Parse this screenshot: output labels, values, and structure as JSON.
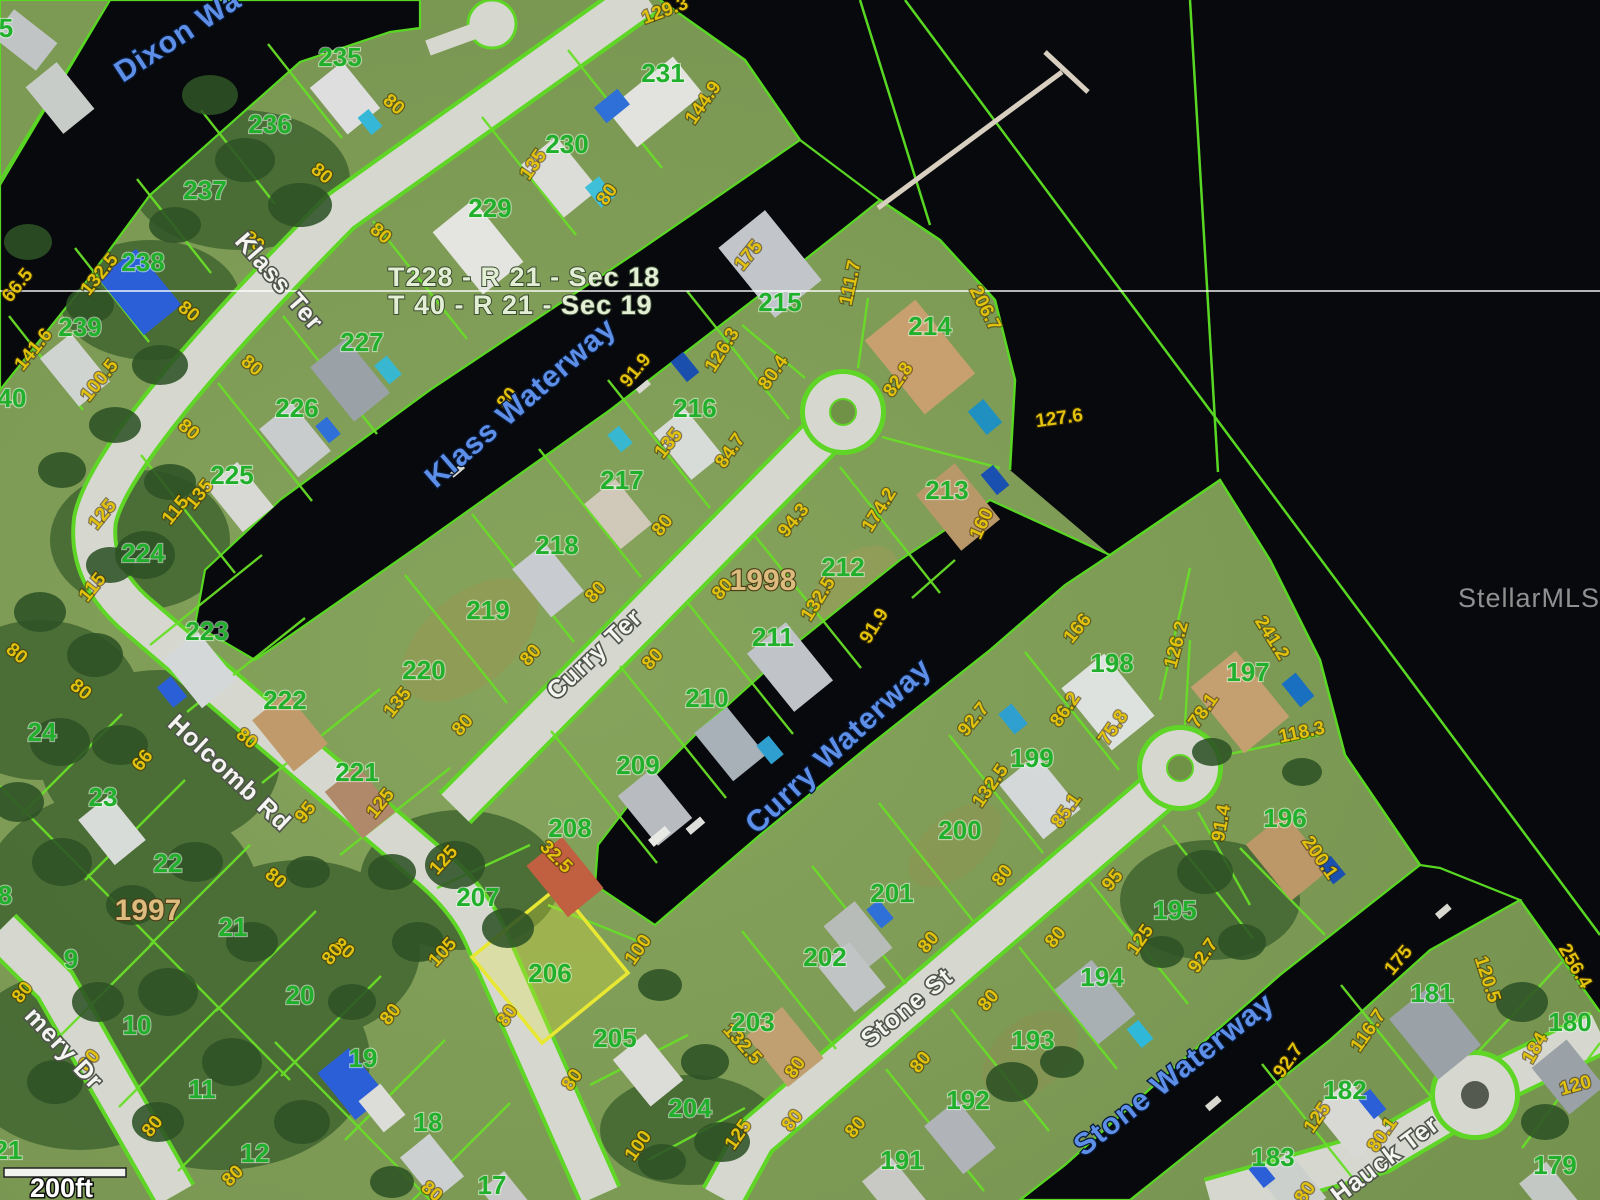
{
  "watermark": "StellarMLS",
  "scale": {
    "label": "200ft"
  },
  "section_labels": [
    "T228 - R 21 - Sec 18",
    "T 40 - R 21 - Sec 19"
  ],
  "plat_labels": [
    {
      "text": "1998",
      "x": 763,
      "y": 590
    },
    {
      "text": "1997",
      "x": 148,
      "y": 920
    }
  ],
  "highlighted_lot": "206",
  "colors": {
    "parcel_line": "#68de28",
    "highlight_parcel": "#e8e833",
    "lot_number": "#21b02c",
    "dimension_text": "#e2c20c",
    "waterway_text": "#5d8fe8",
    "street_text": "#f4f4f0",
    "water": "#07090c",
    "road": "#d6d8d0",
    "plat_text": "#dcbc7e"
  },
  "streets": [
    {
      "name": "Klass Ter",
      "x": 273,
      "y": 287,
      "rot": 49
    },
    {
      "name": "Holcomb Rd",
      "x": 224,
      "y": 779,
      "rot": 43
    },
    {
      "name": "Curry Ter",
      "x": 600,
      "y": 660,
      "rot": -43
    },
    {
      "name": "Stone St",
      "x": 912,
      "y": 1014,
      "rot": -39
    },
    {
      "name": "mery Dr",
      "x": 58,
      "y": 1054,
      "rot": 47
    },
    {
      "name": "Hauck Ter",
      "x": 1390,
      "y": 1166,
      "rot": -37
    }
  ],
  "waterways": [
    {
      "name": "Dixon Wa",
      "x": 183,
      "y": 44,
      "rot": -33
    },
    {
      "name": "Klass Waterway",
      "x": 527,
      "y": 410,
      "rot": -41
    },
    {
      "name": "Curry Waterway",
      "x": 845,
      "y": 753,
      "rot": -43
    },
    {
      "name": "Stone Waterway",
      "x": 1180,
      "y": 1082,
      "rot": -38
    }
  ],
  "lots": [
    {
      "n": "235",
      "x": 340,
      "y": 66
    },
    {
      "n": "236",
      "x": 270,
      "y": 133
    },
    {
      "n": "237",
      "x": 205,
      "y": 199
    },
    {
      "n": "238",
      "x": 143,
      "y": 271
    },
    {
      "n": "239",
      "x": 80,
      "y": 336
    },
    {
      "n": "40",
      "x": 12,
      "y": 407
    },
    {
      "n": "5",
      "x": 6,
      "y": 37
    },
    {
      "n": "231",
      "x": 663,
      "y": 82
    },
    {
      "n": "230",
      "x": 567,
      "y": 153
    },
    {
      "n": "229",
      "x": 490,
      "y": 217
    },
    {
      "n": "227",
      "x": 362,
      "y": 351
    },
    {
      "n": "226",
      "x": 297,
      "y": 417
    },
    {
      "n": "225",
      "x": 232,
      "y": 484
    },
    {
      "n": "224",
      "x": 143,
      "y": 562
    },
    {
      "n": "223",
      "x": 207,
      "y": 640
    },
    {
      "n": "222",
      "x": 285,
      "y": 709
    },
    {
      "n": "221",
      "x": 357,
      "y": 781
    },
    {
      "n": "215",
      "x": 780,
      "y": 311
    },
    {
      "n": "216",
      "x": 695,
      "y": 417
    },
    {
      "n": "217",
      "x": 622,
      "y": 489
    },
    {
      "n": "218",
      "x": 557,
      "y": 554
    },
    {
      "n": "219",
      "x": 488,
      "y": 619
    },
    {
      "n": "220",
      "x": 424,
      "y": 679
    },
    {
      "n": "214",
      "x": 930,
      "y": 335
    },
    {
      "n": "213",
      "x": 947,
      "y": 499
    },
    {
      "n": "212",
      "x": 843,
      "y": 576
    },
    {
      "n": "211",
      "x": 773,
      "y": 646
    },
    {
      "n": "210",
      "x": 707,
      "y": 707
    },
    {
      "n": "209",
      "x": 638,
      "y": 774
    },
    {
      "n": "208",
      "x": 570,
      "y": 837
    },
    {
      "n": "207",
      "x": 478,
      "y": 906
    },
    {
      "n": "206",
      "x": 550,
      "y": 982
    },
    {
      "n": "205",
      "x": 615,
      "y": 1047
    },
    {
      "n": "204",
      "x": 690,
      "y": 1117
    },
    {
      "n": "198",
      "x": 1112,
      "y": 672
    },
    {
      "n": "197",
      "x": 1248,
      "y": 681
    },
    {
      "n": "199",
      "x": 1032,
      "y": 767
    },
    {
      "n": "196",
      "x": 1285,
      "y": 827
    },
    {
      "n": "200",
      "x": 960,
      "y": 839
    },
    {
      "n": "201",
      "x": 892,
      "y": 902
    },
    {
      "n": "202",
      "x": 825,
      "y": 966
    },
    {
      "n": "203",
      "x": 753,
      "y": 1031
    },
    {
      "n": "195",
      "x": 1175,
      "y": 919
    },
    {
      "n": "194",
      "x": 1102,
      "y": 986
    },
    {
      "n": "193",
      "x": 1033,
      "y": 1049
    },
    {
      "n": "192",
      "x": 968,
      "y": 1109
    },
    {
      "n": "191",
      "x": 902,
      "y": 1169
    },
    {
      "n": "181",
      "x": 1432,
      "y": 1002
    },
    {
      "n": "180",
      "x": 1570,
      "y": 1031
    },
    {
      "n": "182",
      "x": 1345,
      "y": 1099
    },
    {
      "n": "183",
      "x": 1273,
      "y": 1166
    },
    {
      "n": "179",
      "x": 1555,
      "y": 1174
    },
    {
      "n": "24",
      "x": 42,
      "y": 741
    },
    {
      "n": "23",
      "x": 103,
      "y": 806
    },
    {
      "n": "22",
      "x": 168,
      "y": 872
    },
    {
      "n": "21",
      "x": 233,
      "y": 936
    },
    {
      "n": "9",
      "x": 71,
      "y": 968
    },
    {
      "n": "10",
      "x": 137,
      "y": 1034
    },
    {
      "n": "11",
      "x": 202,
      "y": 1098
    },
    {
      "n": "12",
      "x": 255,
      "y": 1162
    },
    {
      "n": "20",
      "x": 300,
      "y": 1004
    },
    {
      "n": "19",
      "x": 363,
      "y": 1067
    },
    {
      "n": "18",
      "x": 428,
      "y": 1131
    },
    {
      "n": "17",
      "x": 492,
      "y": 1194
    },
    {
      "n": "21",
      "x": 8,
      "y": 1159
    },
    {
      "n": "8",
      "x": 5,
      "y": 904
    }
  ],
  "dimensions": [
    {
      "v": "129.3",
      "x": 667,
      "y": 16,
      "r": -20
    },
    {
      "v": "144.9",
      "x": 708,
      "y": 106,
      "r": -55
    },
    {
      "v": "80",
      "x": 390,
      "y": 109,
      "r": 40
    },
    {
      "v": "80",
      "x": 318,
      "y": 178,
      "r": 40
    },
    {
      "v": "80",
      "x": 250,
      "y": 246,
      "r": 40
    },
    {
      "v": "80",
      "x": 185,
      "y": 316,
      "r": 40
    },
    {
      "v": "66.5",
      "x": 22,
      "y": 289,
      "r": -51
    },
    {
      "v": "132.5",
      "x": 104,
      "y": 278,
      "r": -51
    },
    {
      "v": "141.6",
      "x": 38,
      "y": 353,
      "r": -51
    },
    {
      "v": "100.5",
      "x": 104,
      "y": 384,
      "r": -51
    },
    {
      "v": "80",
      "x": 377,
      "y": 238,
      "r": 40
    },
    {
      "v": "135",
      "x": 538,
      "y": 168,
      "r": -55
    },
    {
      "v": "80",
      "x": 612,
      "y": 198,
      "r": -55
    },
    {
      "v": "80",
      "x": 248,
      "y": 370,
      "r": 40
    },
    {
      "v": "80",
      "x": 185,
      "y": 434,
      "r": 40
    },
    {
      "v": "135",
      "x": 204,
      "y": 498,
      "r": -51
    },
    {
      "v": "115",
      "x": 180,
      "y": 514,
      "r": -51
    },
    {
      "v": "125",
      "x": 107,
      "y": 518,
      "r": -51
    },
    {
      "v": "115",
      "x": 97,
      "y": 591,
      "r": -51
    },
    {
      "v": "80",
      "x": 13,
      "y": 658,
      "r": 40
    },
    {
      "v": "80",
      "x": 77,
      "y": 694,
      "r": 40
    },
    {
      "v": "66",
      "x": 147,
      "y": 764,
      "r": -51
    },
    {
      "v": "95",
      "x": 310,
      "y": 816,
      "r": -51
    },
    {
      "v": "125",
      "x": 385,
      "y": 807,
      "r": -51
    },
    {
      "v": "135",
      "x": 402,
      "y": 706,
      "r": -51
    },
    {
      "v": "80",
      "x": 243,
      "y": 743,
      "r": 40
    },
    {
      "v": "80",
      "x": 272,
      "y": 883,
      "r": 40
    },
    {
      "v": "80",
      "x": 340,
      "y": 953,
      "r": 40
    },
    {
      "v": "80",
      "x": 27,
      "y": 996,
      "r": -51
    },
    {
      "v": "80",
      "x": 94,
      "y": 1064,
      "r": -51
    },
    {
      "v": "80",
      "x": 157,
      "y": 1130,
      "r": -51
    },
    {
      "v": "80",
      "x": 337,
      "y": 958,
      "r": -51
    },
    {
      "v": "80",
      "x": 395,
      "y": 1018,
      "r": -51
    },
    {
      "v": "80",
      "x": 237,
      "y": 1180,
      "r": -45
    },
    {
      "v": "80",
      "x": 428,
      "y": 1196,
      "r": 40
    },
    {
      "v": "91.9",
      "x": 640,
      "y": 374,
      "r": -51
    },
    {
      "v": "126.3",
      "x": 727,
      "y": 353,
      "r": -58
    },
    {
      "v": "175",
      "x": 753,
      "y": 259,
      "r": -51
    },
    {
      "v": "111.7",
      "x": 856,
      "y": 284,
      "r": -78
    },
    {
      "v": "206.7",
      "x": 980,
      "y": 311,
      "r": 63
    },
    {
      "v": "127.6",
      "x": 1060,
      "y": 424,
      "r": -8
    },
    {
      "v": "82.8",
      "x": 903,
      "y": 383,
      "r": -55
    },
    {
      "v": "84.7",
      "x": 735,
      "y": 454,
      "r": -55
    },
    {
      "v": "80.4",
      "x": 778,
      "y": 376,
      "r": -55
    },
    {
      "v": "135",
      "x": 673,
      "y": 447,
      "r": -51
    },
    {
      "v": "80",
      "x": 667,
      "y": 529,
      "r": -51
    },
    {
      "v": "80",
      "x": 512,
      "y": 402,
      "r": -51
    },
    {
      "v": "80",
      "x": 600,
      "y": 596,
      "r": -48
    },
    {
      "v": "80",
      "x": 535,
      "y": 659,
      "r": -48
    },
    {
      "v": "80",
      "x": 467,
      "y": 729,
      "r": -48
    },
    {
      "v": "80",
      "x": 727,
      "y": 593,
      "r": -48
    },
    {
      "v": "80",
      "x": 657,
      "y": 663,
      "r": -48
    },
    {
      "v": "94.3",
      "x": 798,
      "y": 524,
      "r": -51
    },
    {
      "v": "174.2",
      "x": 884,
      "y": 513,
      "r": -58
    },
    {
      "v": "132.5",
      "x": 823,
      "y": 602,
      "r": -58
    },
    {
      "v": "91.9",
      "x": 879,
      "y": 629,
      "r": -58
    },
    {
      "v": "160",
      "x": 987,
      "y": 526,
      "r": -65
    },
    {
      "v": "100",
      "x": 643,
      "y": 953,
      "r": -55
    },
    {
      "v": "80",
      "x": 512,
      "y": 1019,
      "r": -55
    },
    {
      "v": "105",
      "x": 447,
      "y": 956,
      "r": -48
    },
    {
      "v": "125",
      "x": 448,
      "y": 864,
      "r": -48
    },
    {
      "v": "32.5",
      "x": 552,
      "y": 861,
      "r": 45
    },
    {
      "v": "80",
      "x": 577,
      "y": 1083,
      "r": -55
    },
    {
      "v": "100",
      "x": 643,
      "y": 1149,
      "r": -55
    },
    {
      "v": "125",
      "x": 743,
      "y": 1138,
      "r": -55
    },
    {
      "v": "132.5",
      "x": 738,
      "y": 1048,
      "r": 48
    },
    {
      "v": "80",
      "x": 797,
      "y": 1124,
      "r": -52
    },
    {
      "v": "92.7",
      "x": 978,
      "y": 723,
      "r": -51
    },
    {
      "v": "132.5",
      "x": 995,
      "y": 789,
      "r": -55
    },
    {
      "v": "80",
      "x": 1007,
      "y": 879,
      "r": -52
    },
    {
      "v": "166",
      "x": 1082,
      "y": 632,
      "r": -51
    },
    {
      "v": "86.2",
      "x": 1070,
      "y": 713,
      "r": -55
    },
    {
      "v": "75.8",
      "x": 1118,
      "y": 731,
      "r": -55
    },
    {
      "v": "85.1",
      "x": 1071,
      "y": 814,
      "r": -55
    },
    {
      "v": "126.2",
      "x": 1182,
      "y": 646,
      "r": -75
    },
    {
      "v": "241.2",
      "x": 1267,
      "y": 641,
      "r": 58
    },
    {
      "v": "78.1",
      "x": 1208,
      "y": 714,
      "r": -55
    },
    {
      "v": "118.3",
      "x": 1303,
      "y": 738,
      "r": -12
    },
    {
      "v": "91.4",
      "x": 1227,
      "y": 824,
      "r": -80
    },
    {
      "v": "200.1",
      "x": 1315,
      "y": 861,
      "r": 55
    },
    {
      "v": "92.7",
      "x": 1208,
      "y": 959,
      "r": -55
    },
    {
      "v": "95",
      "x": 1117,
      "y": 884,
      "r": -50
    },
    {
      "v": "125",
      "x": 1145,
      "y": 943,
      "r": -55
    },
    {
      "v": "80",
      "x": 1060,
      "y": 941,
      "r": -50
    },
    {
      "v": "80",
      "x": 993,
      "y": 1004,
      "r": -50
    },
    {
      "v": "80",
      "x": 925,
      "y": 1066,
      "r": -50
    },
    {
      "v": "80",
      "x": 860,
      "y": 1131,
      "r": -50
    },
    {
      "v": "80",
      "x": 800,
      "y": 1071,
      "r": -55
    },
    {
      "v": "80",
      "x": 933,
      "y": 946,
      "r": -50
    },
    {
      "v": "175",
      "x": 1403,
      "y": 964,
      "r": -50
    },
    {
      "v": "120.5",
      "x": 1482,
      "y": 981,
      "r": 72
    },
    {
      "v": "116.7",
      "x": 1373,
      "y": 1034,
      "r": -55
    },
    {
      "v": "92.7",
      "x": 1293,
      "y": 1064,
      "r": -55
    },
    {
      "v": "256.4",
      "x": 1570,
      "y": 969,
      "r": 60
    },
    {
      "v": "120",
      "x": 1577,
      "y": 1091,
      "r": -15
    },
    {
      "v": "184",
      "x": 1540,
      "y": 1051,
      "r": -60
    },
    {
      "v": "125",
      "x": 1322,
      "y": 1121,
      "r": -55
    },
    {
      "v": "80.1",
      "x": 1387,
      "y": 1138,
      "r": -55
    },
    {
      "v": "80",
      "x": 1310,
      "y": 1196,
      "r": -55
    }
  ]
}
